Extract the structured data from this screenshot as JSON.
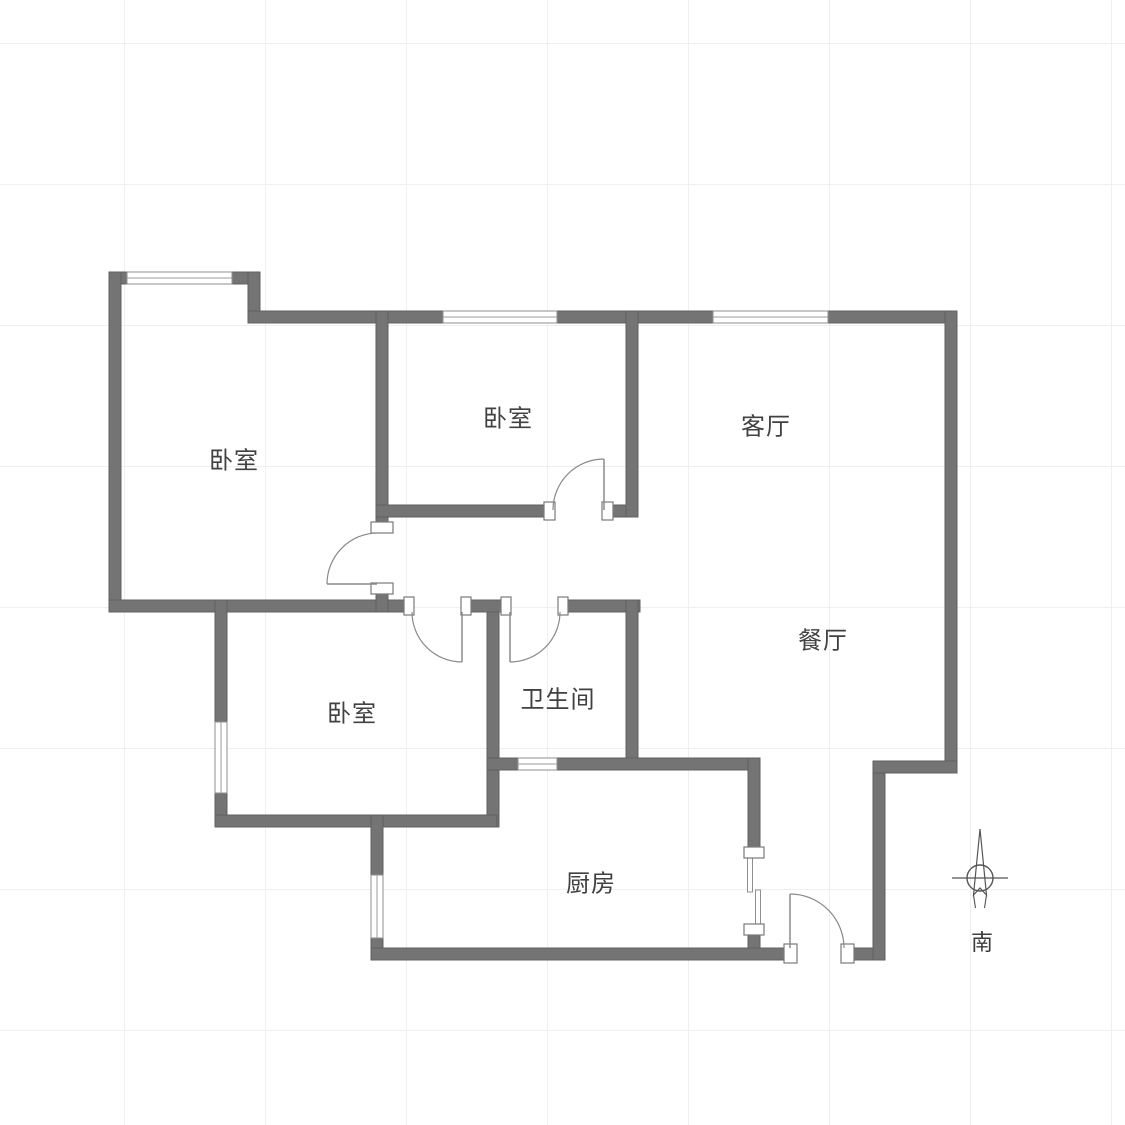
{
  "rooms": [
    {
      "id": "bedroom-top-left",
      "label": "卧室"
    },
    {
      "id": "bedroom-middle",
      "label": "卧室"
    },
    {
      "id": "living-room",
      "label": "客厅"
    },
    {
      "id": "dining-room",
      "label": "餐厅"
    },
    {
      "id": "bedroom-bottom-left",
      "label": "卧室"
    },
    {
      "id": "bathroom",
      "label": "卫生间"
    },
    {
      "id": "kitchen",
      "label": "厨房"
    }
  ],
  "compass": {
    "south_label": "南"
  },
  "openings": {
    "hinged_doors": 5,
    "sliding_doors": 1,
    "windows": 6
  },
  "colors": {
    "wall": "#747474",
    "window_border": "#8f8f8f",
    "door_swing": "#8a8a8a",
    "label_text": "#414141",
    "grid_line": "#efefef",
    "background": "#ffffff"
  }
}
